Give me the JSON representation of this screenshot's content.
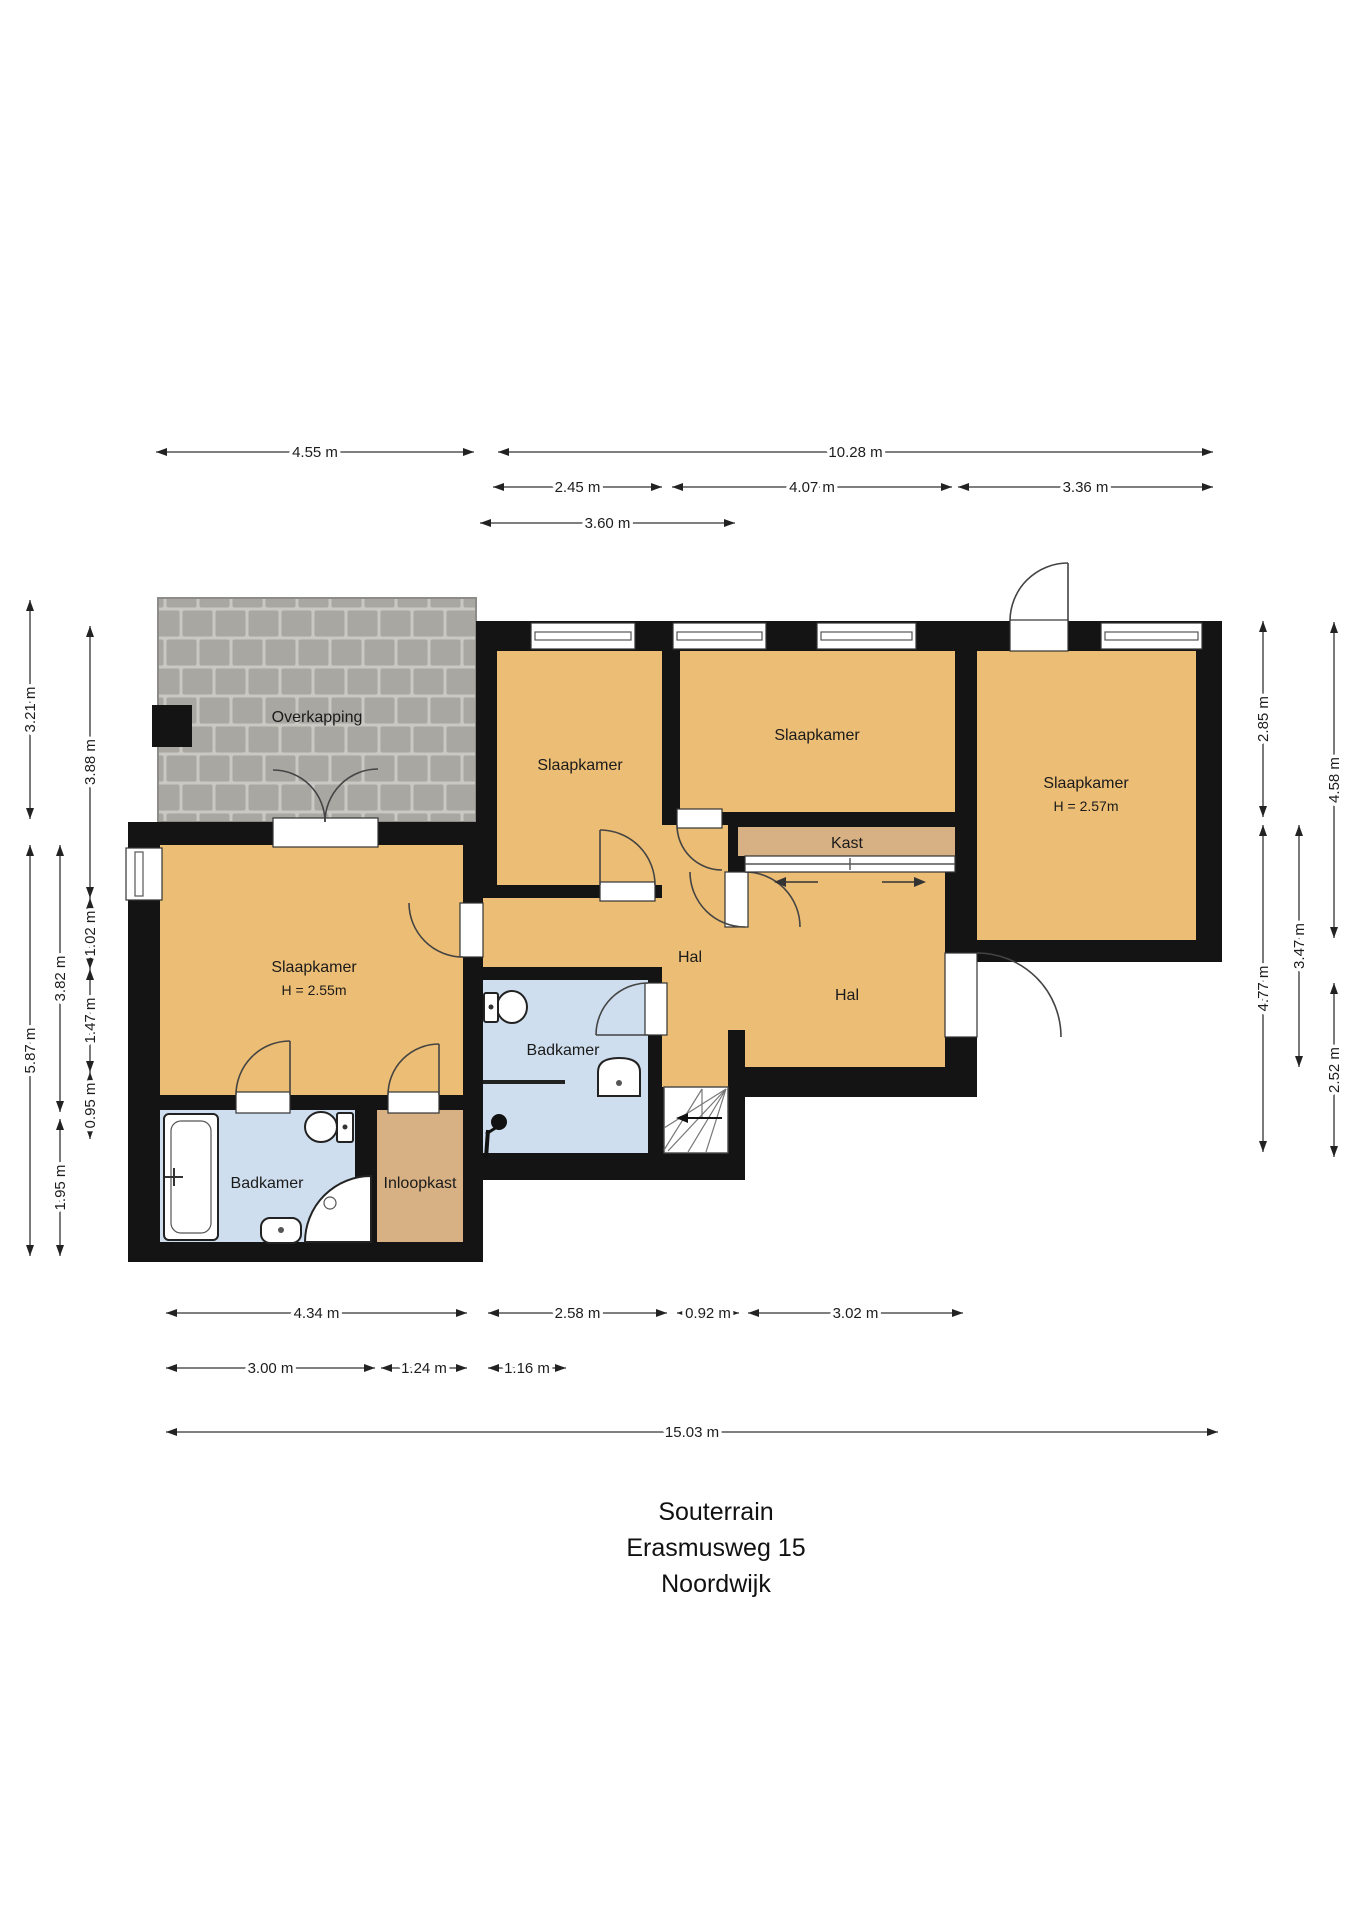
{
  "title": {
    "line1": "Souterrain",
    "line2": "Erasmusweg 15",
    "line3": "Noordwijk"
  },
  "colors": {
    "wall": "#141414",
    "floor": "#ecbd74",
    "kast": "#d7b083",
    "bath": "#cfdeee",
    "paver": "#a8a7a2",
    "paver_joint": "#c9c8c3"
  },
  "rooms": {
    "overkapping": {
      "label": "Overkapping"
    },
    "bedroom_top_left": {
      "label": "Slaapkamer"
    },
    "bedroom_top_middle": {
      "label": "Slaapkamer"
    },
    "bedroom_right": {
      "label": "Slaapkamer",
      "height_note": "H = 2.57m"
    },
    "bedroom_left": {
      "label": "Slaapkamer",
      "height_note": "H = 2.55m"
    },
    "kast": {
      "label": "Kast"
    },
    "hal_corridor": {
      "label": "Hal"
    },
    "hal_right": {
      "label": "Hal"
    },
    "badkamer_middle": {
      "label": "Badkamer"
    },
    "badkamer_left": {
      "label": "Badkamer"
    },
    "inloopkast": {
      "label": "Inloopkast"
    }
  },
  "dimensions": [
    {
      "label": "4.55 m",
      "dir": "h",
      "from": 156,
      "to": 474,
      "at": 452
    },
    {
      "label": "10.28 m",
      "dir": "h",
      "from": 498,
      "to": 1213,
      "at": 452
    },
    {
      "label": "2.45 m",
      "dir": "h",
      "from": 493,
      "to": 662,
      "at": 487
    },
    {
      "label": "4.07 m",
      "dir": "h",
      "from": 672,
      "to": 952,
      "at": 487
    },
    {
      "label": "3.36 m",
      "dir": "h",
      "from": 958,
      "to": 1213,
      "at": 487
    },
    {
      "label": "3.60 m",
      "dir": "h",
      "from": 480,
      "to": 735,
      "at": 523
    },
    {
      "label": "3.21 m",
      "dir": "v",
      "from": 600,
      "to": 819,
      "at": 30
    },
    {
      "label": "5.87 m",
      "dir": "v",
      "from": 845,
      "to": 1256,
      "at": 30
    },
    {
      "label": "3.82 m",
      "dir": "v",
      "from": 845,
      "to": 1112,
      "at": 60
    },
    {
      "label": "1.95 m",
      "dir": "v",
      "from": 1119,
      "to": 1256,
      "at": 60
    },
    {
      "label": "3.88 m",
      "dir": "v",
      "from": 626,
      "to": 898,
      "at": 90
    },
    {
      "label": "1.02 m",
      "dir": "v",
      "from": 898,
      "to": 969,
      "at": 90
    },
    {
      "label": "1.47 m",
      "dir": "v",
      "from": 969,
      "to": 1072,
      "at": 90
    },
    {
      "label": "0.95 m",
      "dir": "v",
      "from": 1072,
      "to": 1139,
      "at": 90
    },
    {
      "label": "2.85 m",
      "dir": "v",
      "from": 621,
      "to": 817,
      "at": 1263
    },
    {
      "label": "4.77 m",
      "dir": "v",
      "from": 825,
      "to": 1152,
      "at": 1263
    },
    {
      "label": "3.47 m",
      "dir": "v",
      "from": 825,
      "to": 1067,
      "at": 1299
    },
    {
      "label": "4.58 m",
      "dir": "v",
      "from": 622,
      "to": 938,
      "at": 1334
    },
    {
      "label": "2.52 m",
      "dir": "v",
      "from": 983,
      "to": 1157,
      "at": 1334
    },
    {
      "label": "4.34 m",
      "dir": "h",
      "from": 166,
      "to": 467,
      "at": 1313
    },
    {
      "label": "2.58 m",
      "dir": "h",
      "from": 488,
      "to": 667,
      "at": 1313
    },
    {
      "label": "0.92 m",
      "dir": "h",
      "from": 677,
      "to": 739,
      "at": 1313
    },
    {
      "label": "3.02 m",
      "dir": "h",
      "from": 748,
      "to": 963,
      "at": 1313
    },
    {
      "label": "3.00 m",
      "dir": "h",
      "from": 166,
      "to": 375,
      "at": 1368
    },
    {
      "label": "1.24 m",
      "dir": "h",
      "from": 381,
      "to": 467,
      "at": 1368
    },
    {
      "label": "1.16 m",
      "dir": "h",
      "from": 488,
      "to": 566,
      "at": 1368
    },
    {
      "label": "15.03 m",
      "dir": "h",
      "from": 166,
      "to": 1218,
      "at": 1432
    }
  ]
}
